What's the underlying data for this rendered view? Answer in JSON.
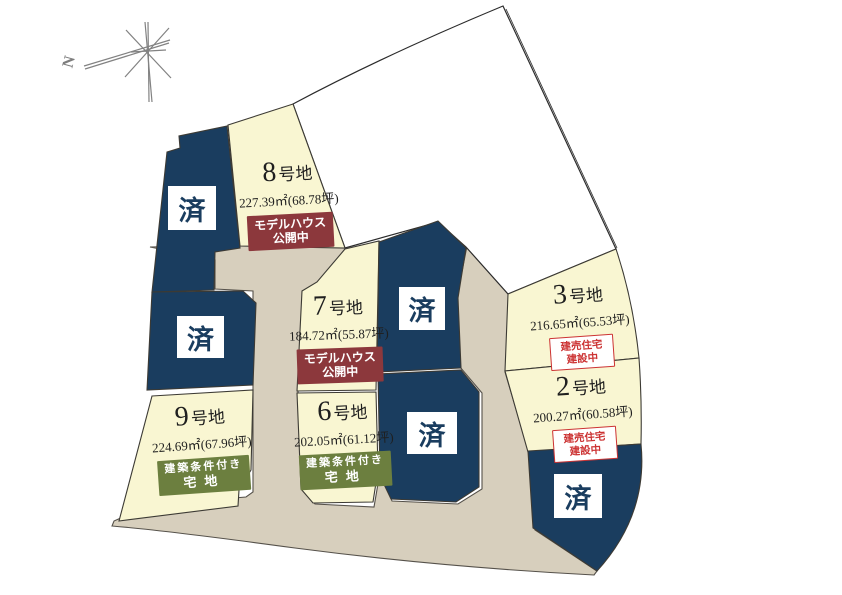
{
  "map": {
    "compass": {
      "north_label": "N"
    },
    "sold_label": "済",
    "lots": [
      {
        "number": "8",
        "suffix": "号地",
        "area": "227.39㎡(68.78坪)",
        "badge": {
          "style": "dark-red",
          "lines": [
            "モデルハウス",
            "公開中"
          ]
        }
      },
      {
        "number": "7",
        "suffix": "号地",
        "area": "184.72㎡(55.87坪)",
        "badge": {
          "style": "dark-red",
          "lines": [
            "モデルハウス",
            "公開中"
          ]
        }
      },
      {
        "number": "3",
        "suffix": "号地",
        "area": "216.65㎡(65.53坪)",
        "badge": {
          "style": "red-outline",
          "lines": [
            "建売住宅",
            "建設中"
          ]
        }
      },
      {
        "number": "2",
        "suffix": "号地",
        "area": "200.27㎡(60.58坪)",
        "badge": {
          "style": "red-outline",
          "lines": [
            "建売住宅",
            "建設中"
          ]
        }
      },
      {
        "number": "9",
        "suffix": "号地",
        "area": "224.69㎡(67.96坪)",
        "badge": {
          "style": "green",
          "lines": [
            "建築条件付き",
            "宅地"
          ]
        }
      },
      {
        "number": "6",
        "suffix": "号地",
        "area": "202.05㎡(61.12坪)",
        "badge": {
          "style": "green",
          "lines": [
            "建築条件付き",
            "宅地"
          ]
        }
      }
    ],
    "colors": {
      "sold_navy": "#1a3d5f",
      "lot_yellow": "#f9f6d2",
      "road_tan": "#d7cfbd",
      "badge_dark_red": "#8c383c",
      "badge_green": "#6c7f3f",
      "badge_outline_red": "#cc3333"
    }
  }
}
